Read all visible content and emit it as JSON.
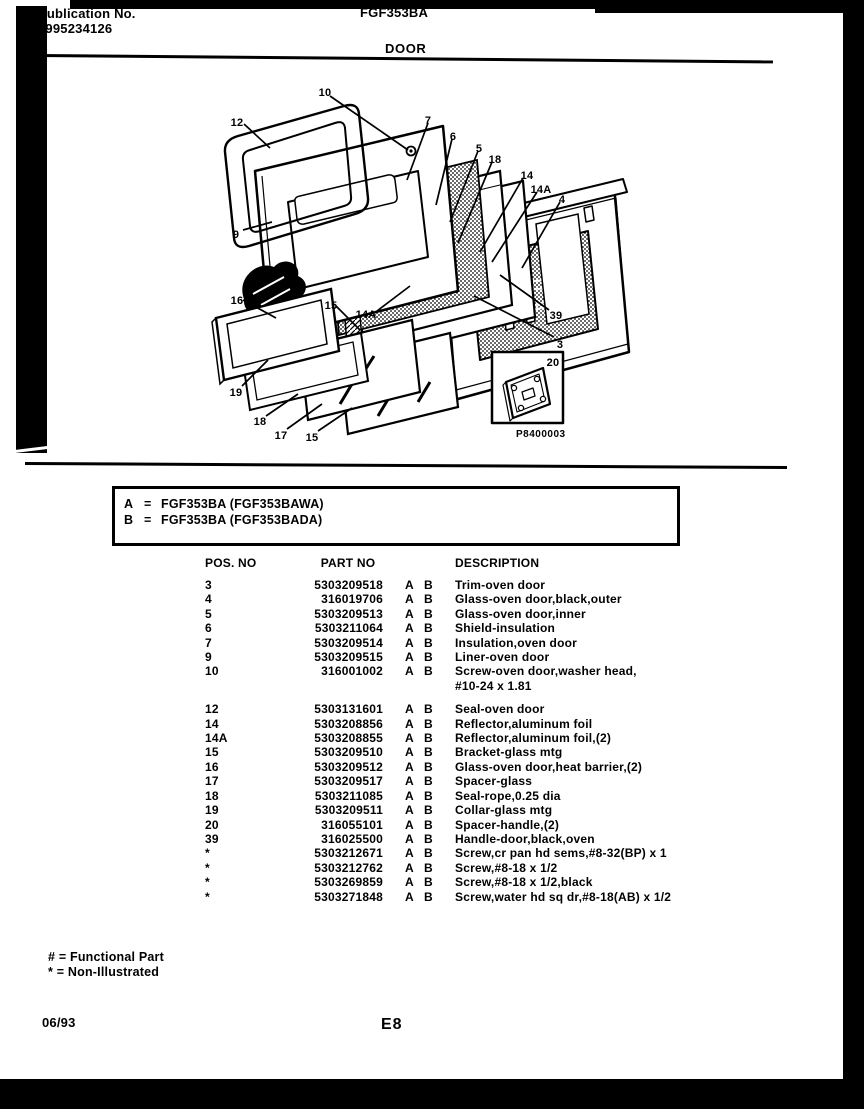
{
  "header": {
    "publication_label": "Publication No.",
    "publication_number": "5995234126",
    "model": "FGF353BA",
    "section_title": "DOOR"
  },
  "diagram": {
    "callouts": [
      "10",
      "12",
      "7",
      "6",
      "5",
      "18",
      "14",
      "14A",
      "4",
      "9",
      "16",
      "15",
      "14A",
      "19",
      "18",
      "17",
      "15",
      "39",
      "3"
    ],
    "inset_callout": "20",
    "figure_code": "P8400003"
  },
  "model_box": {
    "rows": [
      {
        "key": "A",
        "eq": "=",
        "model": "FGF353BA (FGF353BAWA)"
      },
      {
        "key": "B",
        "eq": "=",
        "model": "FGF353BA (FGF353BADA)"
      }
    ]
  },
  "table": {
    "headers": {
      "pos": "POS. NO",
      "part": "PART NO",
      "desc": "DESCRIPTION"
    },
    "rows": [
      {
        "pos": "3",
        "part": "5303209518",
        "ab": "A B",
        "desc": "Trim-oven door"
      },
      {
        "pos": "4",
        "part": "316019706",
        "ab": "A B",
        "desc": "Glass-oven door,black,outer"
      },
      {
        "pos": "5",
        "part": "5303209513",
        "ab": "A B",
        "desc": "Glass-oven door,inner"
      },
      {
        "pos": "6",
        "part": "5303211064",
        "ab": "A B",
        "desc": "Shield-insulation"
      },
      {
        "pos": "7",
        "part": "5303209514",
        "ab": "A B",
        "desc": "Insulation,oven door"
      },
      {
        "pos": "9",
        "part": "5303209515",
        "ab": "A B",
        "desc": "Liner-oven door"
      },
      {
        "pos": "10",
        "part": "316001002",
        "ab": "A B",
        "desc": "Screw-oven door,washer head,",
        "desc2": "#10-24 x 1.81"
      },
      {
        "pos": "12",
        "part": "5303131601",
        "ab": "A B",
        "desc": "Seal-oven door"
      },
      {
        "pos": "14",
        "part": "5303208856",
        "ab": "A B",
        "desc": "Reflector,aluminum foil"
      },
      {
        "pos": "14A",
        "part": "5303208855",
        "ab": "A B",
        "desc": "Reflector,aluminum foil,(2)"
      },
      {
        "pos": "15",
        "part": "5303209510",
        "ab": "A B",
        "desc": "Bracket-glass mtg"
      },
      {
        "pos": "16",
        "part": "5303209512",
        "ab": "A B",
        "desc": "Glass-oven door,heat barrier,(2)"
      },
      {
        "pos": "17",
        "part": "5303209517",
        "ab": "A B",
        "desc": "Spacer-glass"
      },
      {
        "pos": "18",
        "part": "5303211085",
        "ab": "A B",
        "desc": "Seal-rope,0.25 dia"
      },
      {
        "pos": "19",
        "part": "5303209511",
        "ab": "A B",
        "desc": "Collar-glass mtg"
      },
      {
        "pos": "20",
        "part": "316055101",
        "ab": "A B",
        "desc": "Spacer-handle,(2)"
      },
      {
        "pos": "39",
        "part": "316025500",
        "ab": "A B",
        "desc": "Handle-door,black,oven"
      },
      {
        "pos": "*",
        "part": "5303212671",
        "ab": "A B",
        "desc": "Screw,cr pan hd sems,#8-32(BP) x 1"
      },
      {
        "pos": "*",
        "part": "5303212762",
        "ab": "A B",
        "desc": "Screw,#8-18 x 1/2"
      },
      {
        "pos": "*",
        "part": "5303269859",
        "ab": "A B",
        "desc": "Screw,#8-18 x 1/2,black"
      },
      {
        "pos": "*",
        "part": "5303271848",
        "ab": "A B",
        "desc": "Screw,water hd sq dr,#8-18(AB) x 1/2"
      }
    ]
  },
  "legend": {
    "functional": "# = Functional Part",
    "non_illustrated": "* = Non-Illustrated"
  },
  "footer": {
    "date": "06/93",
    "page": "E8"
  }
}
